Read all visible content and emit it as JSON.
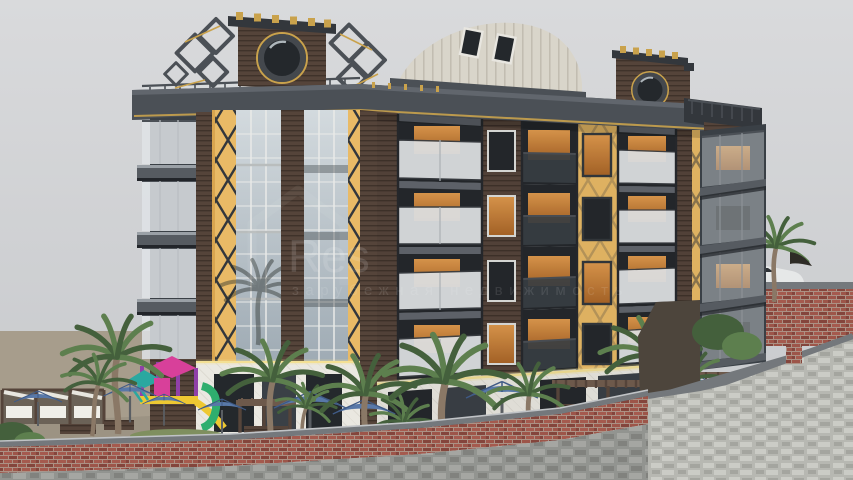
{
  "scene": {
    "type": "3d-architectural-exterior-render",
    "subject": "Modern five-storey apartment building with rooftop gables, curved metal roof, glass curtain wall and yellow lattice accents above a landscaped terrace",
    "time_of_day": "overcast daytime",
    "camera": "street-level three-quarter view",
    "floors_visible": 5,
    "features": [
      "rooftop gables with circular oculus windows",
      "curved standing-seam metal roof with skylights",
      "glass curtain wall tower",
      "yellow diamond-lattice accent strips",
      "frosted-glass balconies with warm lit interiors",
      "children playground with slides",
      "wooden pergolas and cabanas",
      "blue sun umbrellas and loungers",
      "palm trees",
      "red brick and rough stone retaining walls",
      "white car parked behind rear wall"
    ]
  },
  "watermark": {
    "logo": "house-outline",
    "brand": "Res",
    "tagline": "зарубежная недвижимость"
  },
  "colors": {
    "sky1": "#d9dadc",
    "sky2": "#c6c8cb",
    "frame": "#33373c",
    "frame2": "#4b5056",
    "frame3": "#61666d",
    "slab": "#565b61",
    "slabLight": "#9aa0a6",
    "gold": "#c9a24c",
    "goldGlow": "#f3e095",
    "wood": "#55443a",
    "wood2": "#3f322a",
    "woodL": "#6d594b",
    "yellow": "#e9ba66",
    "yellowD": "#d9a54f",
    "glassTop": "#d3dade",
    "glassBot": "#9fabb4",
    "glassDark": "#24282c",
    "glassMid": "#3a4046",
    "warm": "#e09a4d",
    "warmDeep": "#aa6527",
    "frost": "#e9ecee",
    "railGlass": "#dfe3e6",
    "wallWhite": "#eae8e1",
    "wallBase": "#d9d6cd",
    "metal": "#d9d5ca",
    "metalRib": "#bcb7ab",
    "tan": "#a79d8c",
    "tanD": "#948b7b",
    "brickA": "#9d5549",
    "brickB": "#84453c",
    "brickC": "#a55a4e",
    "mortar": "#ac9184",
    "stone": "#9fa19d",
    "stoneHi": "#b3b5b0",
    "stoneLo": "#8c8e89",
    "stoneL": "#b7b8b2",
    "stoneLHi": "#cbccc6",
    "stoneLLo": "#a4a59f",
    "coping": "#74787c",
    "copingLight": "#c0c3c6",
    "darkPatch": "#4d453c",
    "green": "#5d7f4e",
    "greenD": "#44603c",
    "trunk": "#8a7866",
    "blue": "#5878a8",
    "blueRib": "#3f5a86",
    "purple": "#9040a8",
    "magenta": "#d8409a",
    "teal": "#2aa8a0",
    "playYellow": "#eec832",
    "playGreen": "#2fae6e",
    "carBody": "#e6e8e8",
    "carGlass": "#2e3236",
    "concrete": "#b8b5ac",
    "grass": "#7f8f5f",
    "watermark": "#ffffff"
  }
}
